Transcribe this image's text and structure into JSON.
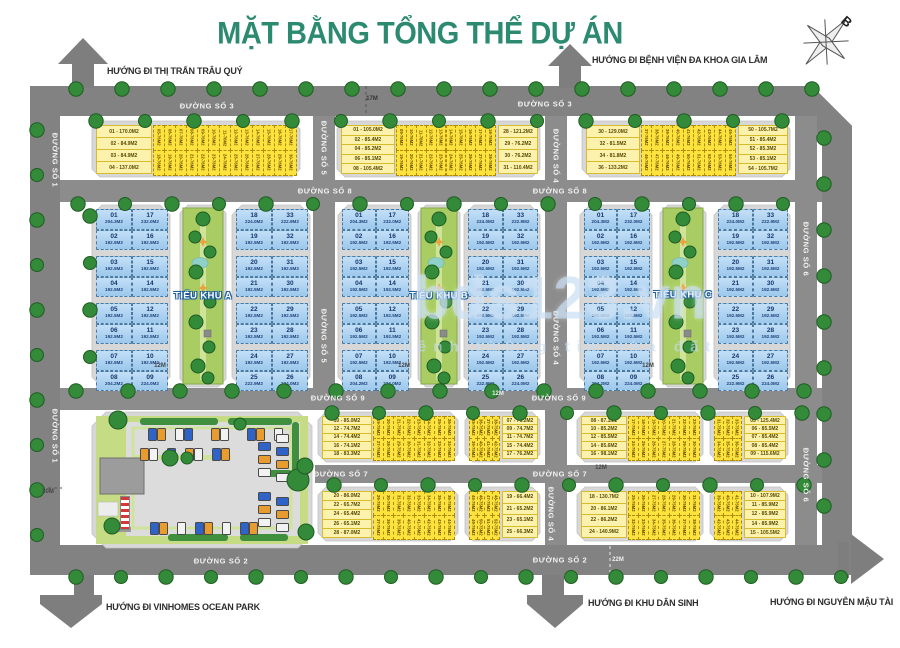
{
  "title": "MẶT BẰNG TỔNG THỂ DỰ ÁN",
  "compass_label": "B",
  "watermark": {
    "brand": "bds123.vn",
    "tagline": "kênh thông tin nhà đất"
  },
  "directions": {
    "top_left": "HƯỚNG ĐI THỊ TRẤN TRÂU QUÝ",
    "top_right": "HƯỚNG ĐI BỆNH VIỆN ĐA KHOA GIA LÂM",
    "bottom_left": "HƯỚNG ĐI VINHOMES OCEAN PARK",
    "bottom_center": "HƯỚNG ĐI KHU DÂN SINH",
    "bottom_right": "HƯỚNG ĐI NGUYỄN MẬU TÀI"
  },
  "road_labels": {
    "d1": "ĐƯỜNG SỐ 1",
    "d2": "ĐƯỜNG SỐ 2",
    "d3": "ĐƯỜNG SỐ 3",
    "d4": "ĐƯỜNG SỐ 4",
    "d5": "ĐƯỜNG SỐ 5",
    "d6": "ĐƯỜNG SỐ 6",
    "d7": "ĐƯỜNG SỐ 7",
    "d8": "ĐƯỜNG SỐ 8",
    "d9": "ĐƯỜNG SỐ 9"
  },
  "dimensions": {
    "w17": "17M",
    "w12": "12M",
    "w30": "30M",
    "w22": "22M"
  },
  "zones": {
    "a": "TIỂU KHU A",
    "b": "TIỂU KHU B",
    "c": "TIỂU KHU C"
  },
  "blue_block_template": {
    "left": {
      "col1": [
        [
          "01",
          "204.3M2"
        ],
        [
          "02",
          "192.5M2"
        ],
        [
          "03",
          "192.5M2"
        ],
        [
          "04",
          "192.5M2"
        ],
        [
          "05",
          "192.5M2"
        ],
        [
          "06",
          "192.5M2"
        ],
        [
          "07",
          "192.5M2"
        ],
        [
          "08",
          "204.2M2"
        ]
      ],
      "col2": [
        [
          "17",
          "232.0M2"
        ],
        [
          "16",
          "192.5M2"
        ],
        [
          "15",
          "192.5M2"
        ],
        [
          "14",
          "192.5M2"
        ],
        [
          "12",
          "192.5M2"
        ],
        [
          "11",
          "192.5M2"
        ],
        [
          "10",
          "192.5M2"
        ],
        [
          "09",
          "224.0M2"
        ]
      ]
    },
    "right": {
      "col1": [
        [
          "18",
          "224.0M2"
        ],
        [
          "19",
          "192.5M2"
        ],
        [
          "20",
          "192.5M2"
        ],
        [
          "21",
          "192.5M2"
        ],
        [
          "22",
          "192.5M2"
        ],
        [
          "23",
          "192.5M2"
        ],
        [
          "24",
          "192.5M2"
        ],
        [
          "25",
          "222.9M2"
        ]
      ],
      "col2": [
        [
          "33",
          "222.9M2"
        ],
        [
          "32",
          "192.5M2"
        ],
        [
          "31",
          "192.5M2"
        ],
        [
          "30",
          "192.5M2"
        ],
        [
          "29",
          "192.5M2"
        ],
        [
          "28",
          "192.5M2"
        ],
        [
          "27",
          "192.5M2"
        ],
        [
          "26",
          "224.0M2"
        ]
      ]
    }
  },
  "yellow_blocks": {
    "t1": {
      "corner_left": [
        "01 - 170.0M2",
        "02 - 84.9M2",
        "03 - 84.9M2",
        "04 - 137.0M2"
      ],
      "strips": {
        "start": 5,
        "top": 13,
        "bottom": 13,
        "area": "76M2"
      }
    },
    "t2": {
      "corner_left": [
        "01 - 105.0M2",
        "02 - 85.4M2",
        "04 - 85.2M2",
        "06 - 85.1M2",
        "08 - 105.4M2"
      ],
      "corner_right": [
        "28 - 121.2M2",
        "29 - 76.2M2",
        "30 - 76.2M2",
        "31 - 110.4M2"
      ],
      "strips": {
        "start": 9,
        "top": 10,
        "bottom": 10,
        "area": "76M2"
      }
    },
    "t3": {
      "corner_left": [
        "30 - 129.0M2",
        "32 - 81.5M2",
        "34 - 81.8M2",
        "36 - 133.2M2"
      ],
      "corner_right": [
        "50 - 105.7M2",
        "51 - 85.4M2",
        "52 - 85.3M2",
        "53 - 85.1M2",
        "54 - 105.7M2"
      ],
      "strips": {
        "start": 37,
        "top": 9,
        "bottom": 9,
        "area": "76M2"
      }
    },
    "b31": {
      "corner_left": [
        "10 - 85.0M2",
        "12 - 74.7M2",
        "14 - 74.4M2",
        "16 - 74.1M2",
        "18 - 83.3M2"
      ],
      "strips": {
        "start": 19,
        "top": 8,
        "bottom": 8,
        "area": "75M2"
      }
    },
    "b32": {
      "corner_right": [
        "07 - 76.2M2",
        "09 - 74.7M2",
        "11 - 74.7M2",
        "15 - 74.4M2",
        "17 - 76.2M2"
      ],
      "strips": {
        "start": 35,
        "top": 4,
        "bottom": 4,
        "area": "75M2"
      }
    },
    "b33": {
      "corner_left": [
        "08 - 87.1M2",
        "10 - 85.2M2",
        "12 - 85.5M2",
        "14 - 85.6M2",
        "16 - 98.1M2"
      ],
      "strips": {
        "start": 17,
        "top": 7,
        "bottom": 7,
        "area": "75M2"
      }
    },
    "b34": {
      "corner_right": [
        "05 - 125.4M2",
        "06 - 85.5M2",
        "07 - 85.4M2",
        "08 - 85.4M2",
        "09 - 115.6M2"
      ],
      "strips": {
        "start": 31,
        "top": 3,
        "bottom": 3,
        "area": "75M2"
      }
    },
    "b41": {
      "corner_left": [
        "20 - 86.0M2",
        "22 - 65.7M2",
        "24 - 65.4M2",
        "26 - 65.1M2",
        "28 - 87.0M2"
      ],
      "strips": {
        "start": 29,
        "top": 8,
        "bottom": 8,
        "area": "75M2"
      }
    },
    "b42": {
      "corner_right": [
        "19 - 66.4M2",
        "21 - 65.2M2",
        "23 - 65.1M2",
        "25 - 66.3M2"
      ],
      "strips": {
        "start": 45,
        "top": 4,
        "bottom": 4,
        "area": "75M2"
      }
    },
    "b43": {
      "corner_left": [
        "18 - 130.7M2",
        "20 - 86.1M2",
        "22 - 86.2M2",
        "24 - 140.9M2"
      ],
      "strips": {
        "start": 25,
        "top": 7,
        "bottom": 7,
        "area": "75M2"
      }
    },
    "b44": {
      "corner_right": [
        "10 - 107.9M2",
        "11 - 85.9M2",
        "12 - 85.9M2",
        "14 - 85.9M2",
        "15 - 105.5M2"
      ],
      "strips": {
        "start": 39,
        "top": 3,
        "bottom": 3,
        "area": "75M2"
      }
    }
  },
  "colors": {
    "title": "#2b8a70",
    "road": "#8c8c8c",
    "road_dark": "#828282",
    "platform": "#d7d7d7",
    "yellow": "#fee23e",
    "yellow_light": "#fdf2ad",
    "blue": "#a9cfee",
    "blue_border": "#49799f",
    "blue_text": "#14386b",
    "green_zone": "#a9cd62",
    "green_lane": "#cfe39b",
    "tree": "#338a38",
    "school_green": "#c6dc84",
    "hedge": "#3f8f3f",
    "pond": "#8fd0c8",
    "watermark": "#c7ddf3",
    "car_blue": "#2f63c8",
    "car_white": "#f2f2f2",
    "car_orange": "#e89b2e"
  }
}
